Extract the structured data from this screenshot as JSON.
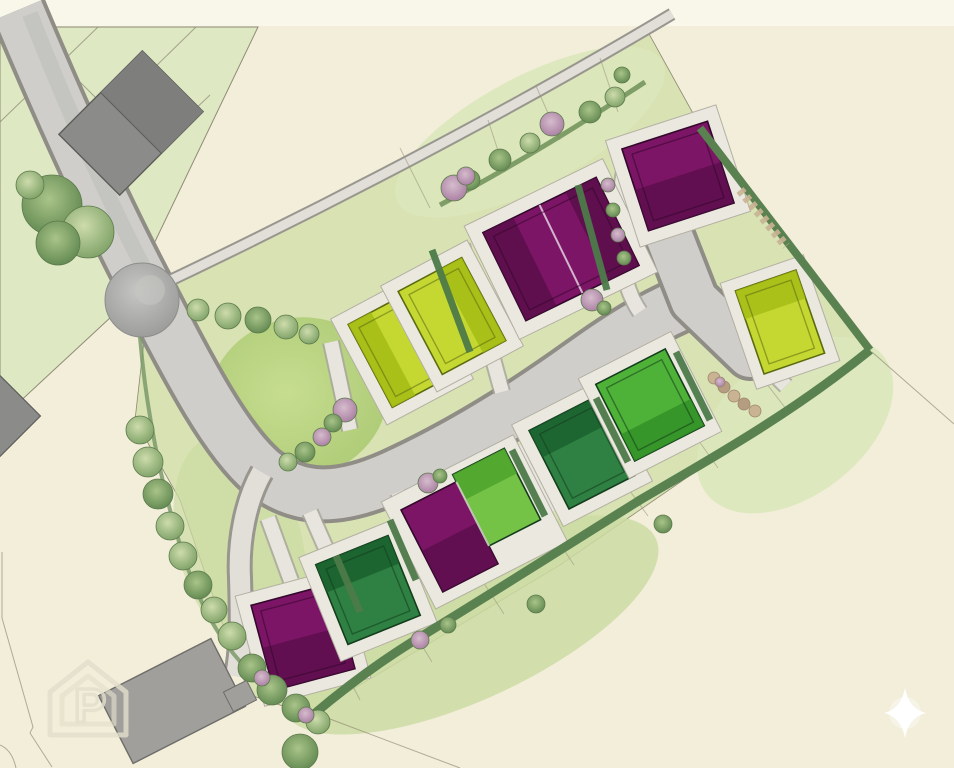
{
  "scene": {
    "description": "Watercolour residential development site plan, plan view, no text labels",
    "type": "site-plan"
  },
  "colors": {
    "background": "#f2eeda",
    "top_strip": "#f9f7ea",
    "parcel_green": "#dde8c2",
    "site_green": "#d8e2b2",
    "garden_light": "#dce7ba",
    "garden_mid": "#ccdba2",
    "lawn_green": "#b9d582",
    "road_fill": "#cfceca",
    "road_edge": "#8f8d85",
    "footpath_fill": "#e1dfd7",
    "driveway_fill": "#e7e5dd",
    "pad_fill": "#ebe9df",
    "plot_purple": "#7c1566",
    "plot_purple_shade": "#560d47",
    "plot_chartreuse": "#c5d832",
    "plot_chartreuse_shade": "#a2bc14",
    "plot_green_light": "#74c246",
    "plot_green_light_shade": "#4ea32d",
    "plot_green_mid": "#4fb238",
    "plot_green_mid_shade": "#2f8f26",
    "plot_green_dark": "#2e8142",
    "plot_green_dark_shade": "#195f2d",
    "existing_grey_dark": "#7e7e7c",
    "existing_grey": "#8b8b89",
    "existing_grey_light": "#a09f9b",
    "hedge_green": "#5a8150",
    "tree_green": "#9cb77e",
    "tree_grey": "#a9a9a7",
    "shrub_pink": "#bb93b3",
    "stone_tan": "#c9b393",
    "line_brown": "#8a8670",
    "watermark_grey": "#e3dfcc",
    "star_white": "#ffffff"
  },
  "plots": [
    {
      "id": "north-1",
      "row": "north",
      "color_name": "chartreuse",
      "units_visible": 1
    },
    {
      "id": "north-2",
      "row": "north",
      "color_name": "chartreuse",
      "units_visible": 1
    },
    {
      "id": "north-3",
      "row": "north",
      "color_name": "purple",
      "units_visible": 2
    },
    {
      "id": "north-4",
      "row": "north",
      "color_name": "purple",
      "units_visible": 1
    },
    {
      "id": "east-1",
      "row": "east",
      "color_name": "chartreuse",
      "units_visible": 1
    },
    {
      "id": "south-1",
      "row": "south",
      "color_name": "purple",
      "units_visible": 1
    },
    {
      "id": "south-2",
      "row": "south",
      "color_name": "dark-green",
      "units_visible": 1
    },
    {
      "id": "south-3",
      "row": "south",
      "color_name": "purple",
      "units_visible": 1
    },
    {
      "id": "south-4",
      "row": "south",
      "color_name": "light-green",
      "units_visible": 1
    },
    {
      "id": "south-5",
      "row": "south",
      "color_name": "dark-green",
      "units_visible": 1
    },
    {
      "id": "south-6",
      "row": "south",
      "color_name": "mid-green",
      "units_visible": 1
    }
  ],
  "existing_buildings": [
    {
      "id": "north-west-pair",
      "color_name": "dark-grey"
    },
    {
      "id": "south-west-house",
      "color_name": "grey"
    },
    {
      "id": "west-edge-partial",
      "color_name": "grey"
    },
    {
      "id": "small-garage",
      "color_name": "grey"
    }
  ],
  "landscape": {
    "feature_tree_grey": 1,
    "tree_cluster_north_west": 3,
    "street_trees_north": 5,
    "boundary_trees_west": 8,
    "boundary_hedges": "east and south site edges",
    "open_space_lawn": "west of street bend"
  },
  "watermark": {
    "letter": "P",
    "shape": "house-outline"
  },
  "sparkle": {
    "shape": "four-point-star"
  }
}
